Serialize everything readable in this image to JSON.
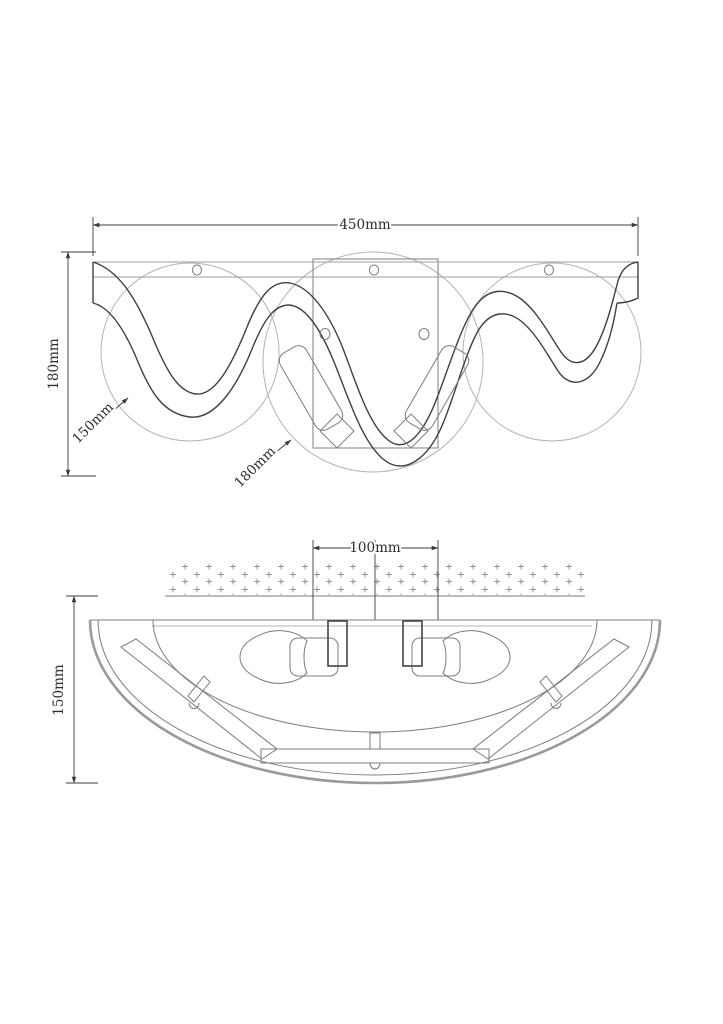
{
  "meta": {
    "title": "Wall lamp technical dimension drawing",
    "canvas": {
      "width": 723,
      "height": 1024
    },
    "background": "#ffffff"
  },
  "palette": {
    "dim_line": "#3c3c3c",
    "object_dark": "#3f3f3f",
    "object_mid": "#7d7d7d",
    "object_light": "#b3b3b3",
    "outer_rim": "#9a9a9a",
    "hatch_mark": "#8a8a8a",
    "text": "#2e2e2e"
  },
  "front_view": {
    "name": "front-elevation",
    "dimensions": {
      "overall_width": {
        "label": "450mm"
      },
      "overall_height": {
        "label": "180mm"
      },
      "small_shade_diameter": {
        "label": "150mm"
      },
      "large_shade_diameter": {
        "label": "180mm"
      }
    }
  },
  "plan_view": {
    "name": "bottom-plan",
    "dimensions": {
      "backplate_width": {
        "label": "100mm"
      },
      "projection_depth": {
        "label": "150mm"
      }
    }
  }
}
